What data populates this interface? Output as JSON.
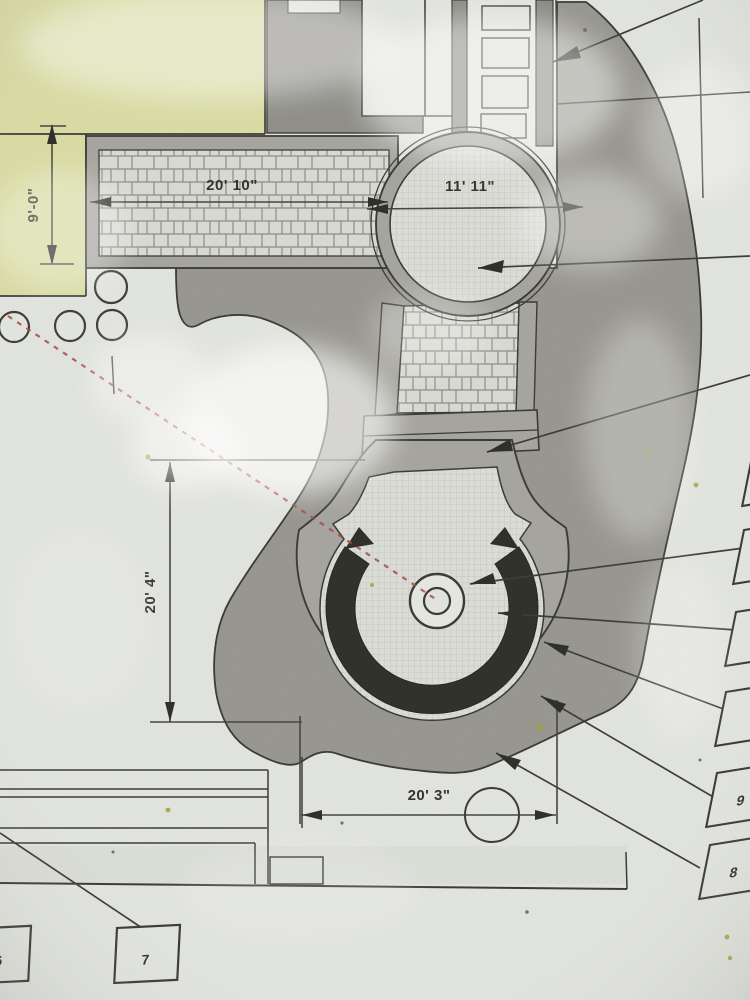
{
  "dimensions": {
    "walkway_width": "9'-0\"",
    "walkway_length": "20' 10\"",
    "circle_diameter": "11' 11\"",
    "plaza_height": "20' 4\"",
    "plaza_width": "20' 3\""
  },
  "keynotes": {
    "left_partial": "6",
    "bottom": "7",
    "right_lower": "8",
    "right_upper": "9"
  },
  "colors": {
    "paper": "#e3e5e0",
    "planting_bed": "#98978f",
    "paving_band": "#a6a59f",
    "paver_field": "#dcded8",
    "seat_wall": "#2f2f2a",
    "building": "#dadda4",
    "block_gray": "#8f8e88",
    "guide_red": "#a84a3e"
  }
}
